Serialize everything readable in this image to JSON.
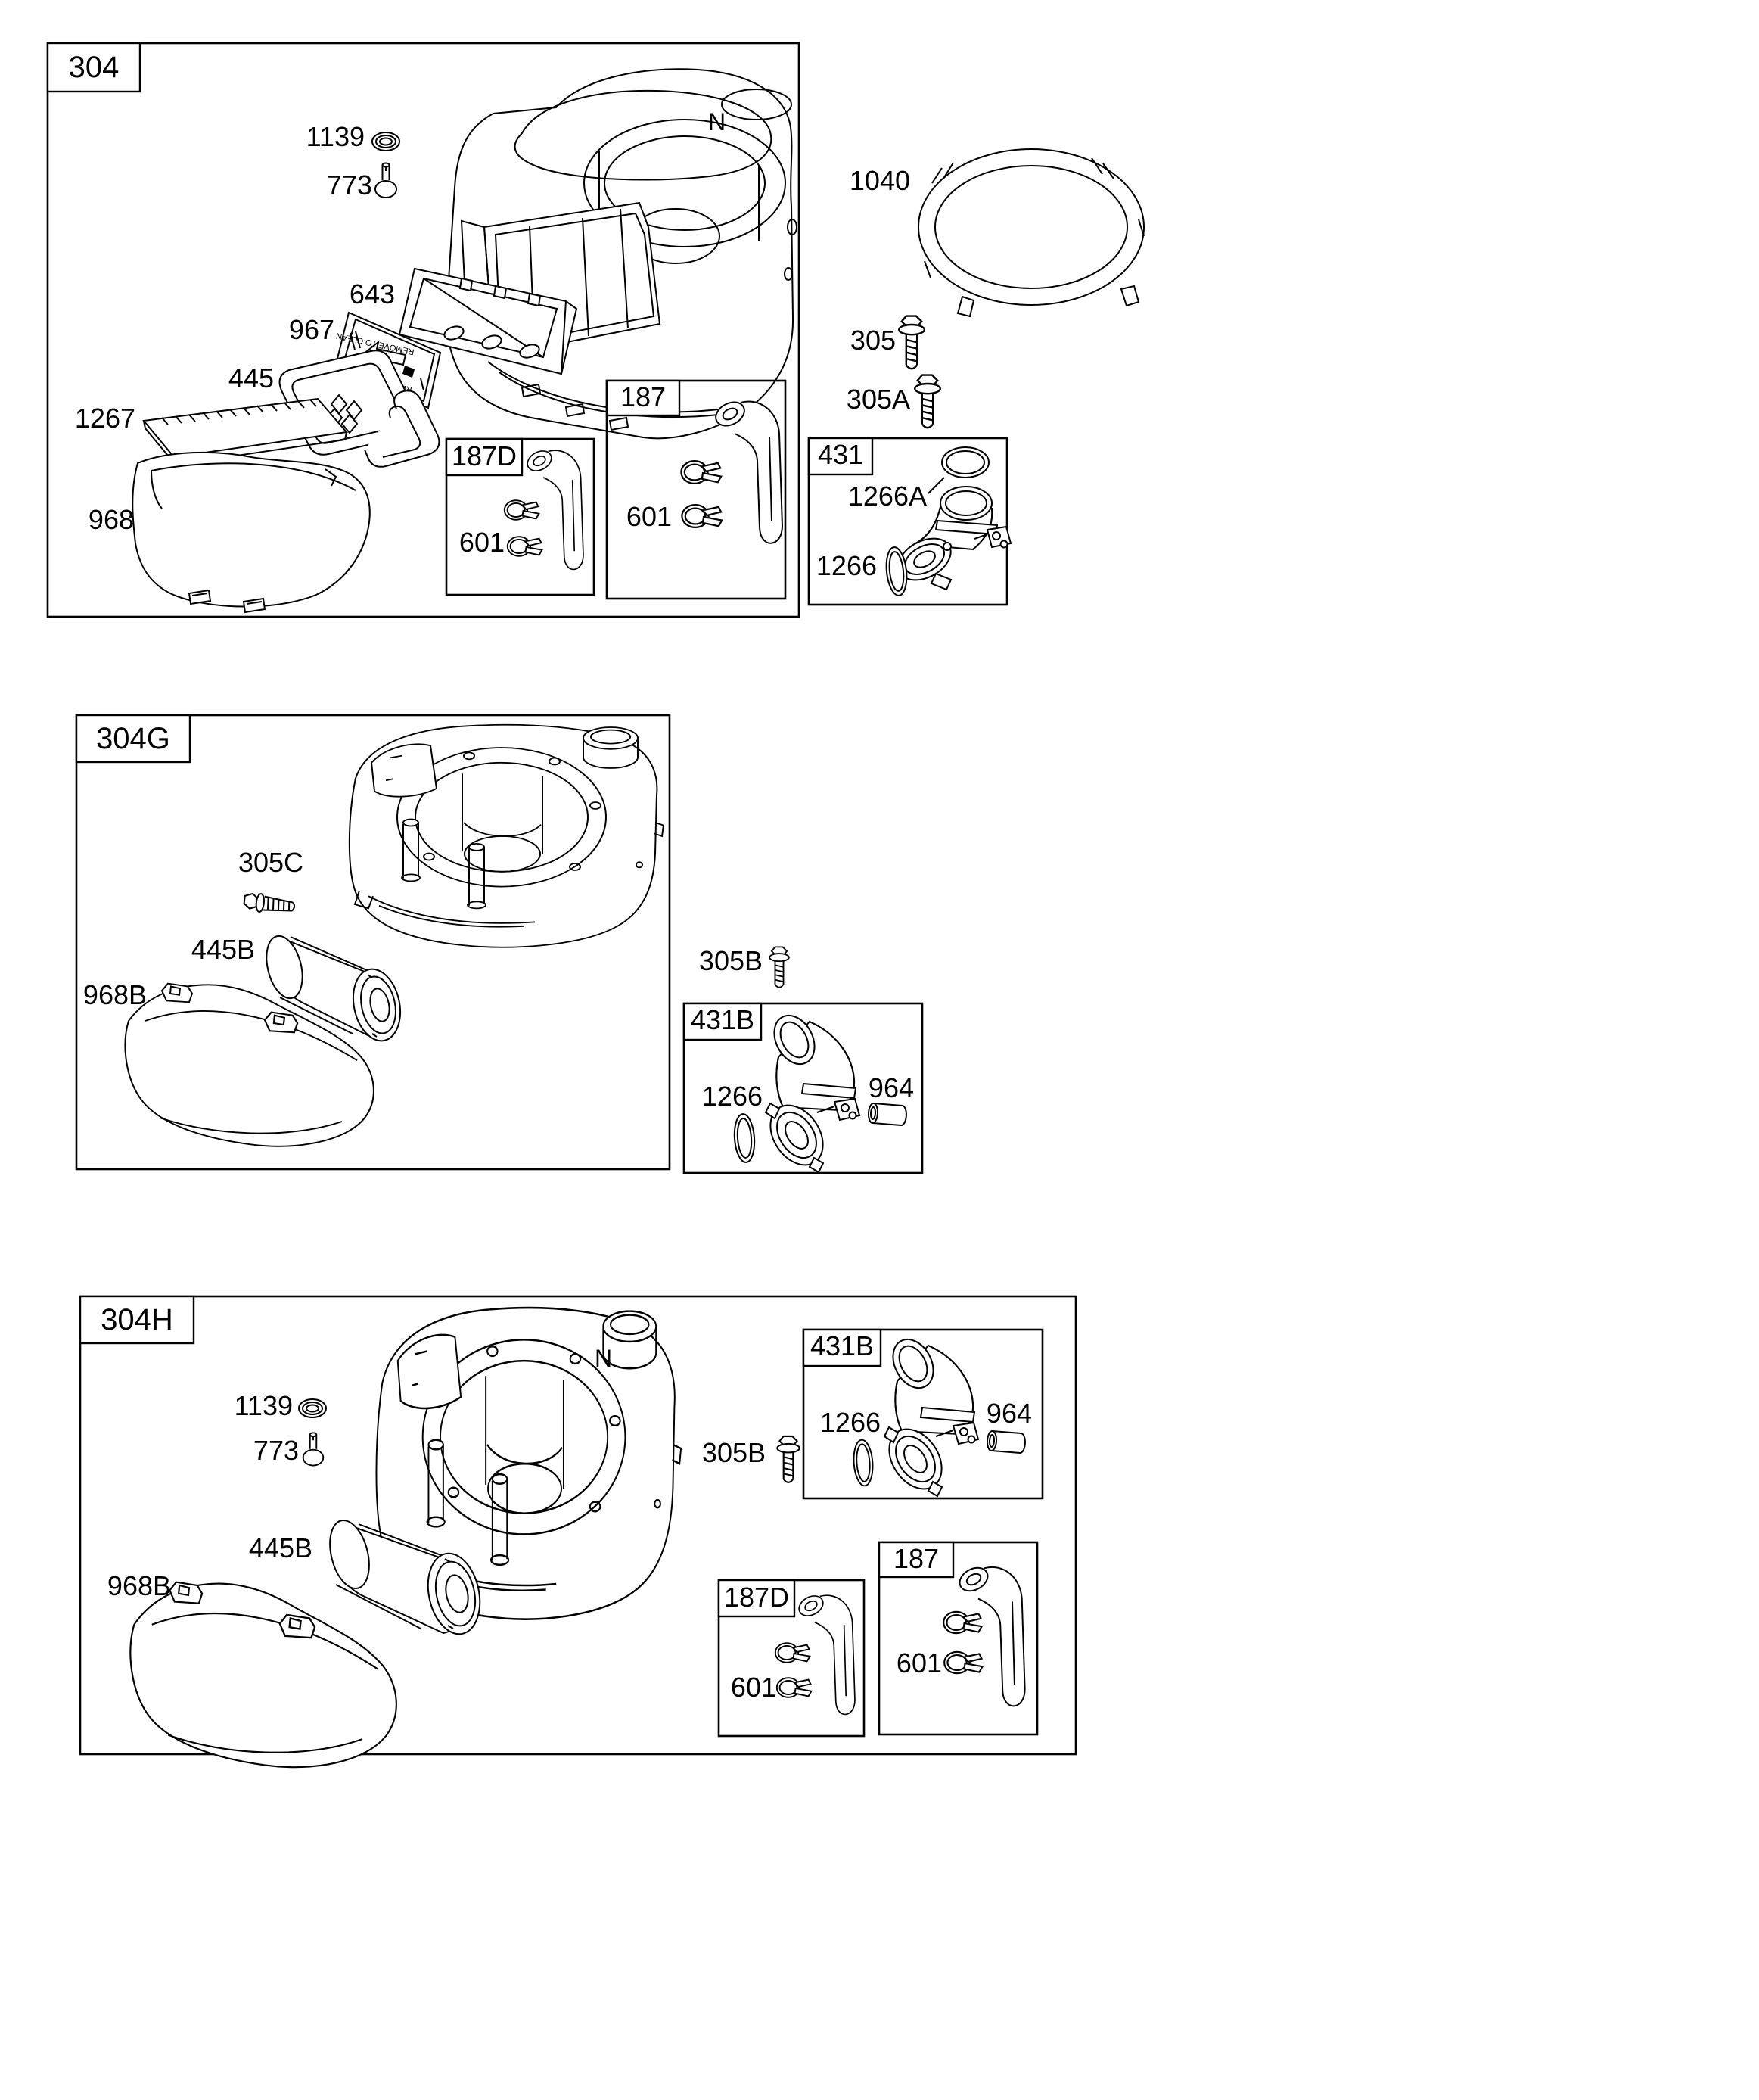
{
  "palette": {
    "paper": "#ffffff",
    "ink": "#000000"
  },
  "s304": {
    "id": "304",
    "housing_letter": "N",
    "plate_text": "REMOVE TO CLEAN",
    "callouts": {
      "p1139": "1139",
      "p773": "773",
      "p643": "643",
      "p967": "967",
      "p445": "445",
      "p1267": "1267",
      "p968": "968"
    },
    "b187d": {
      "id": "187D",
      "p601": "601"
    },
    "b187": {
      "id": "187",
      "p601": "601"
    }
  },
  "r304": {
    "p1040": "1040",
    "p305": "305",
    "p305a": "305A",
    "b431": {
      "id": "431",
      "p1266a": "1266A",
      "p1266": "1266"
    }
  },
  "s304g": {
    "id": "304G",
    "callouts": {
      "p305c": "305C",
      "p445b": "445B",
      "p968b": "968B"
    }
  },
  "r304g": {
    "p305b": "305B",
    "b431b": {
      "id": "431B",
      "p1266": "1266",
      "p964": "964"
    }
  },
  "s304h": {
    "id": "304H",
    "housing_letter": "N",
    "callouts": {
      "p1139": "1139",
      "p773": "773",
      "p445b": "445B",
      "p968b": "968B",
      "p305b": "305B"
    },
    "b431b": {
      "id": "431B",
      "p1266": "1266",
      "p964": "964"
    },
    "b187d": {
      "id": "187D",
      "p601": "601"
    },
    "b187": {
      "id": "187",
      "p601": "601"
    }
  }
}
